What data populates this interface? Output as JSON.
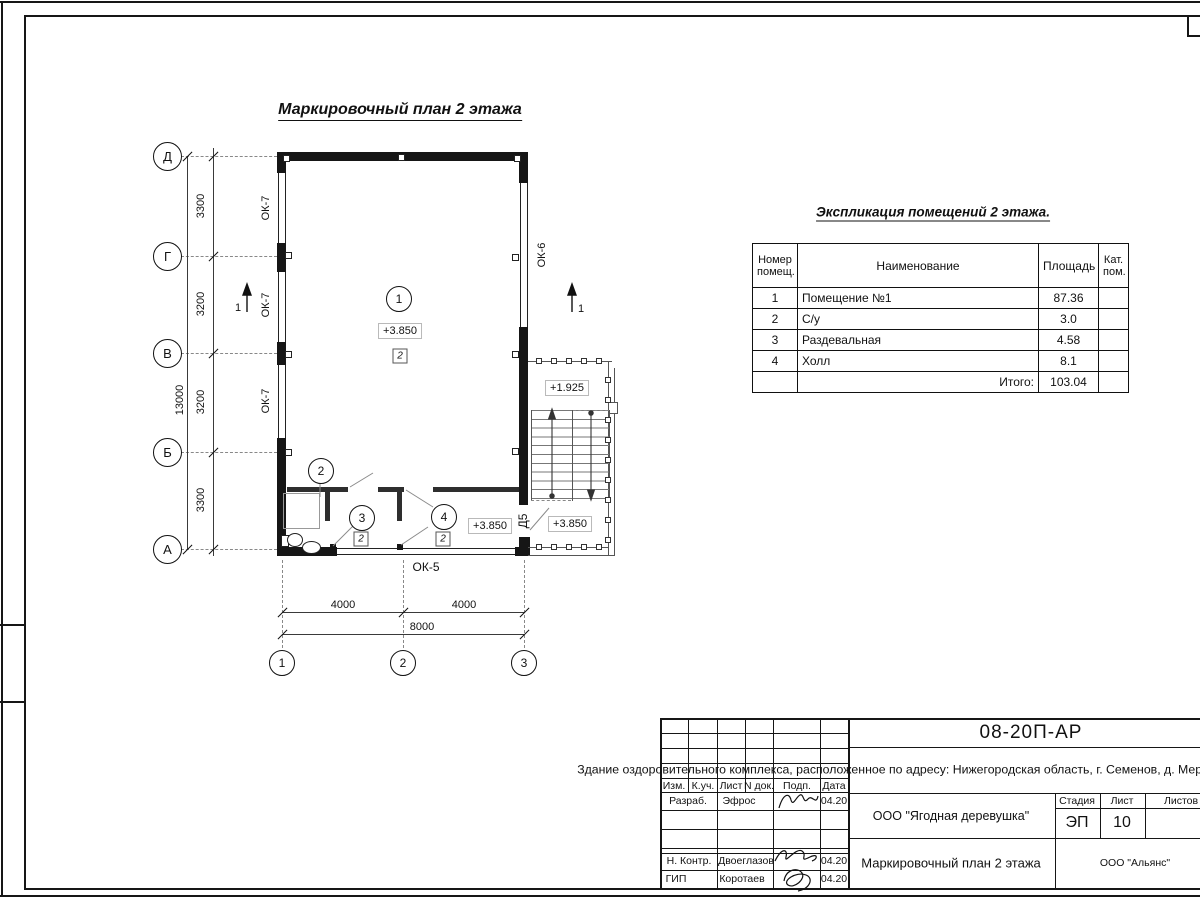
{
  "titles": {
    "plan": "Маркировочный план 2 этажа",
    "explication": "Экспликация помещений 2 этажа."
  },
  "axes": {
    "h": [
      "Д",
      "Г",
      "В",
      "Б",
      "А"
    ],
    "v": [
      "1",
      "2",
      "3"
    ]
  },
  "dims": {
    "s1": "3300",
    "s2": "3200",
    "s3": "3200",
    "s4": "3300",
    "total_v": "13000",
    "b1": "4000",
    "b2": "4000",
    "total_b": "8000"
  },
  "marks": {
    "ok7": "ОК-7",
    "ok6": "ОК-6",
    "ok5": "ОК-5",
    "d5": "Д5",
    "section": "1",
    "floor_type": "2"
  },
  "elev": {
    "main": "+3.850",
    "stair_mid": "+1.925",
    "stair_low": "+3.850",
    "room4": "+3.850"
  },
  "rooms": [
    "1",
    "2",
    "3",
    "4"
  ],
  "table": {
    "h_num": "Номер\nпомещ.",
    "h_name": "Наименование",
    "h_area": "Площадь",
    "h_cat": "Кат.\nпом.",
    "rows": [
      {
        "n": "1",
        "name": "Помещение №1",
        "area": "87.36"
      },
      {
        "n": "2",
        "name": "С/у",
        "area": "3.0"
      },
      {
        "n": "3",
        "name": "Раздевальная",
        "area": "4.58"
      },
      {
        "n": "4",
        "name": "Холл",
        "area": "8.1"
      }
    ],
    "total_label": "Итого:",
    "total": "103.04"
  },
  "stamp": {
    "doc_number": "08-20П-АР",
    "project": "Здание оздоровительного комплекса, расположенное по\nадресу: Нижегородская область, г. Семенов, д. Мериново,\nтуристическая база «Ягодная деревушка»",
    "cols": {
      "izm": "Изм.",
      "kuch": "К.уч.",
      "list": "Лист",
      "ndoc": "N док.",
      "podp": "Подп.",
      "data": "Дата"
    },
    "rows": [
      {
        "role": "Разраб.",
        "name": "Эфрос",
        "date": "04.20"
      },
      {
        "role": "Н. Контр.",
        "name": "Двоеглазов",
        "date": "04.20"
      },
      {
        "role": "ГИП",
        "name": "Коротаев",
        "date": "04.20"
      }
    ],
    "client": "ООО \"Ягодная деревушка\"",
    "stage_label": "Стадия",
    "sheet_label": "Лист",
    "sheets_label": "Листов",
    "stage": "ЭП",
    "sheet": "10",
    "drawing_title": "Маркировочный план 2 этажа",
    "org": "ООО \"Альянс\""
  }
}
